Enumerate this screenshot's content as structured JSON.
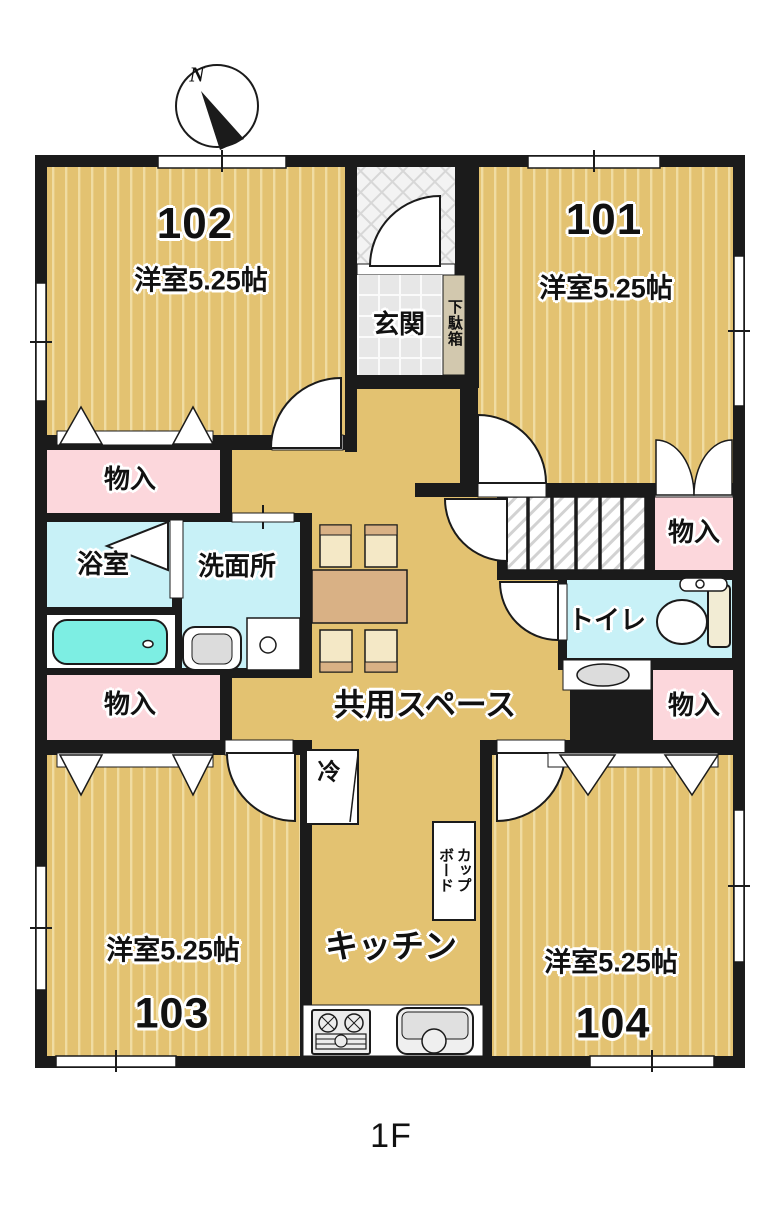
{
  "floor_label": "1F",
  "compass": {
    "north_label": "N"
  },
  "rooms": {
    "room101": {
      "number": "101",
      "size": "洋室5.25帖"
    },
    "room102": {
      "number": "102",
      "size": "洋室5.25帖"
    },
    "room103": {
      "number": "103",
      "size": "洋室5.25帖"
    },
    "room104": {
      "number": "104",
      "size": "洋室5.25帖"
    },
    "entrance": {
      "label": "玄関"
    },
    "shoe_cabinet": {
      "label": "下駄箱"
    },
    "storage_top_left": {
      "label": "物入"
    },
    "storage_bottom_left": {
      "label": "物入"
    },
    "storage_top_right": {
      "label": "物入"
    },
    "storage_bottom_right": {
      "label": "物入"
    },
    "bathroom": {
      "label": "浴室"
    },
    "washroom": {
      "label": "洗面所"
    },
    "toilet": {
      "label": "トイレ"
    },
    "common_space": {
      "label": "共用スペース"
    },
    "kitchen": {
      "label": "キッチン"
    },
    "refrigerator": {
      "label": "冷"
    },
    "cupboard": {
      "lines": [
        "カップ",
        "ボード"
      ]
    }
  },
  "colors": {
    "wall": "#1b1b1b",
    "room_floor": "#e3c271",
    "room_stripe": "#f0dca2",
    "storage_pink": "#fcd7dc",
    "wet_area_cyan": "#c8f1f7",
    "bathtub_cyan": "#7deee3",
    "table_tan": "#d9b185",
    "chair_beige": "#f4e8c6",
    "shoe_cabinet_beige": "#d2c8ae"
  }
}
